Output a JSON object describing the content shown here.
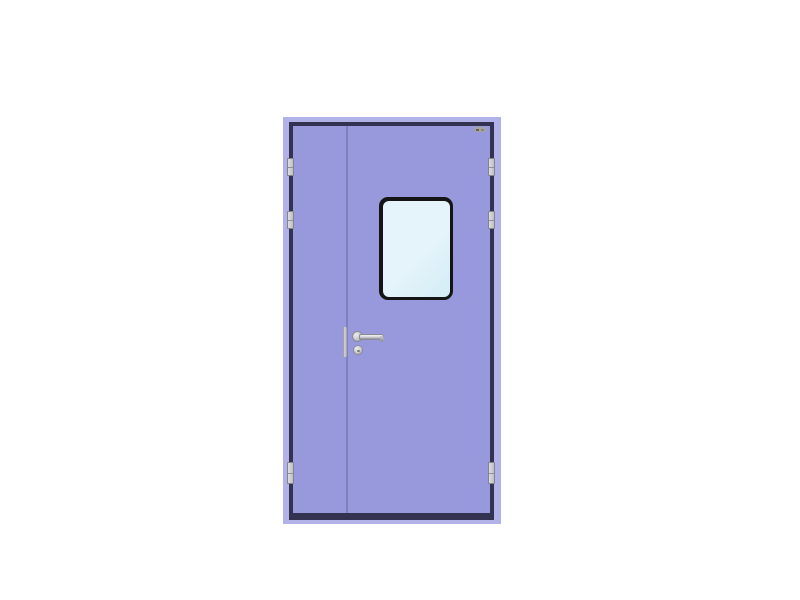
{
  "image": {
    "kind": "product-photo",
    "subject": "Unequal double-leaf cleanroom door, lavender finish, white backdrop"
  },
  "door": {
    "frame_label": "door frame",
    "left_leaf_label": "narrow inactive leaf",
    "right_leaf_label": "active leaf",
    "vision_window_label": "vision window",
    "handle_label": "lever handle",
    "lock_cylinder_label": "lock cylinder",
    "edge_plate_label": "meeting-stile plate",
    "hinge_label": "hinge",
    "hinge_count": 6,
    "sticker_label": "brand sticker"
  },
  "colors": {
    "background": "#ffffff",
    "frame_band": "#b1b2e8",
    "outline": "#333351",
    "leaf": "#9799dc",
    "division": "#7e80c0",
    "window_frame": "#151515",
    "glass": "#e5f4fa",
    "glass_edge": "#d3ecf5",
    "silver_hi": "#ececee",
    "silver": "#c9c9cd",
    "silver_dk": "#8b8b94",
    "sticker_bg": "#a3a3ab",
    "sticker_mark1": "#6b5f4e",
    "sticker_mark2": "#8e8474"
  }
}
